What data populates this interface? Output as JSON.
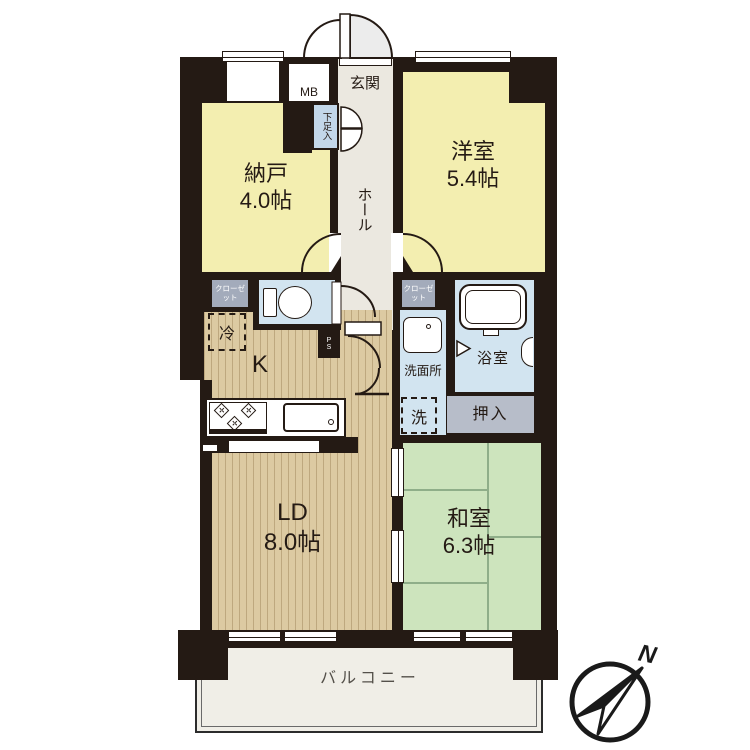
{
  "title": "apartment-floor-plan",
  "rooms": {
    "nando": {
      "label": "納戸",
      "size": "4.0帖"
    },
    "yoshitsu": {
      "label": "洋室",
      "size": "5.4帖"
    },
    "washitsu": {
      "label": "和室",
      "size": "6.3帖"
    },
    "ld": {
      "label": "LD",
      "size": "8.0帖"
    },
    "kitchen": {
      "label": "K"
    },
    "genkan": {
      "label": "玄関"
    },
    "hall": {
      "label": "ホール"
    },
    "senmenjo": {
      "label": "洗面所"
    },
    "yokushitsu": {
      "label": "浴室"
    },
    "oshiire": {
      "label": "押入"
    },
    "balcony": {
      "label": "バルコニー"
    }
  },
  "fixtures": {
    "meter_box": "MB",
    "shoe_cabinet": "下足入",
    "closet_left": "クローゼット",
    "closet_right": "クローゼット",
    "refrigerator": "冷",
    "washing_machine": "洗",
    "pipe_space": "PS"
  },
  "compass": {
    "north_label": "N"
  },
  "colors": {
    "wall": "#241a14",
    "western_room": "#f3eeb0",
    "tatami_room": "#cde4bd",
    "wood_floor": "#dccaa2",
    "wet_area": "#d2e4f0",
    "corridor": "#ebe8e0",
    "closet_gray": "#a3abbb",
    "oshiire_gray": "#b7bdc9",
    "balcony_floor": "#f0eee7"
  }
}
